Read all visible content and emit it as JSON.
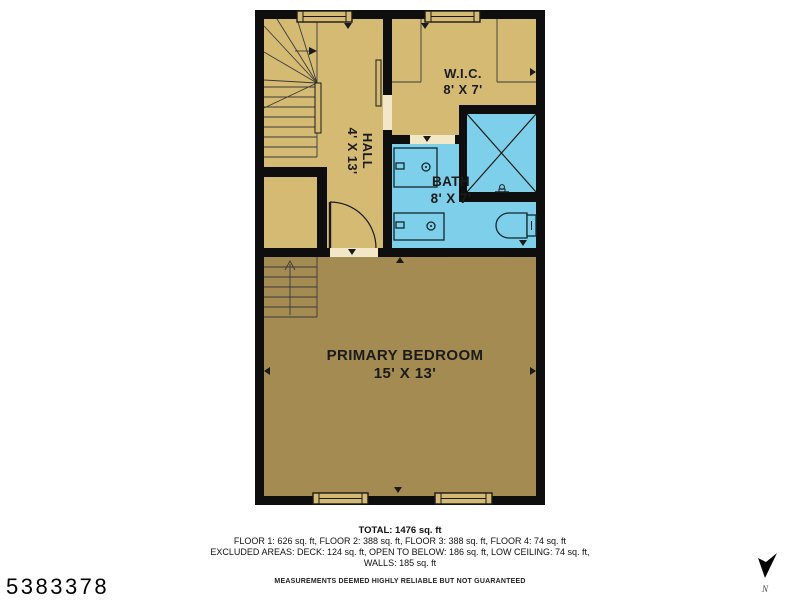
{
  "listing_id": "5383378",
  "north": {
    "icon": "north-arrow-icon",
    "label": "N"
  },
  "colors": {
    "wall": "#0e0e0e",
    "floor_light": "#d4ba72",
    "floor_dark": "#a48b51",
    "bath_blue": "#7ecfe9",
    "threshold": "#f2e7c6",
    "line": "#1a1a1a"
  },
  "floorplan": {
    "rooms": [
      {
        "name": "W.I.C.",
        "dims": "8' X 7'"
      },
      {
        "name": "HALL",
        "dims": "4' X 13'"
      },
      {
        "name": "BATH",
        "dims": "8' X 7'"
      },
      {
        "name": "PRIMARY BEDROOM",
        "dims": "15' X 13'"
      }
    ],
    "fixtures": [
      "staircase",
      "winder-stairs",
      "door-swing",
      "pocket-door",
      "vanity-sink",
      "vanity-sink",
      "shower",
      "toilet",
      "window",
      "window",
      "window",
      "window"
    ]
  },
  "summary": {
    "total_label": "TOTAL: 1476 sq. ft",
    "floors_line": "FLOOR 1: 626 sq. ft, FLOOR 2: 388 sq. ft, FLOOR 3: 388 sq. ft, FLOOR 4: 74 sq. ft",
    "excluded_line": "EXCLUDED AREAS: DECK: 124 sq. ft, OPEN TO BELOW: 186 sq. ft, LOW CEILING: 74 sq. ft,",
    "walls_line": "WALLS: 185 sq. ft",
    "disclaimer": "MEASUREMENTS DEEMED HIGHLY RELIABLE BUT NOT GUARANTEED"
  }
}
